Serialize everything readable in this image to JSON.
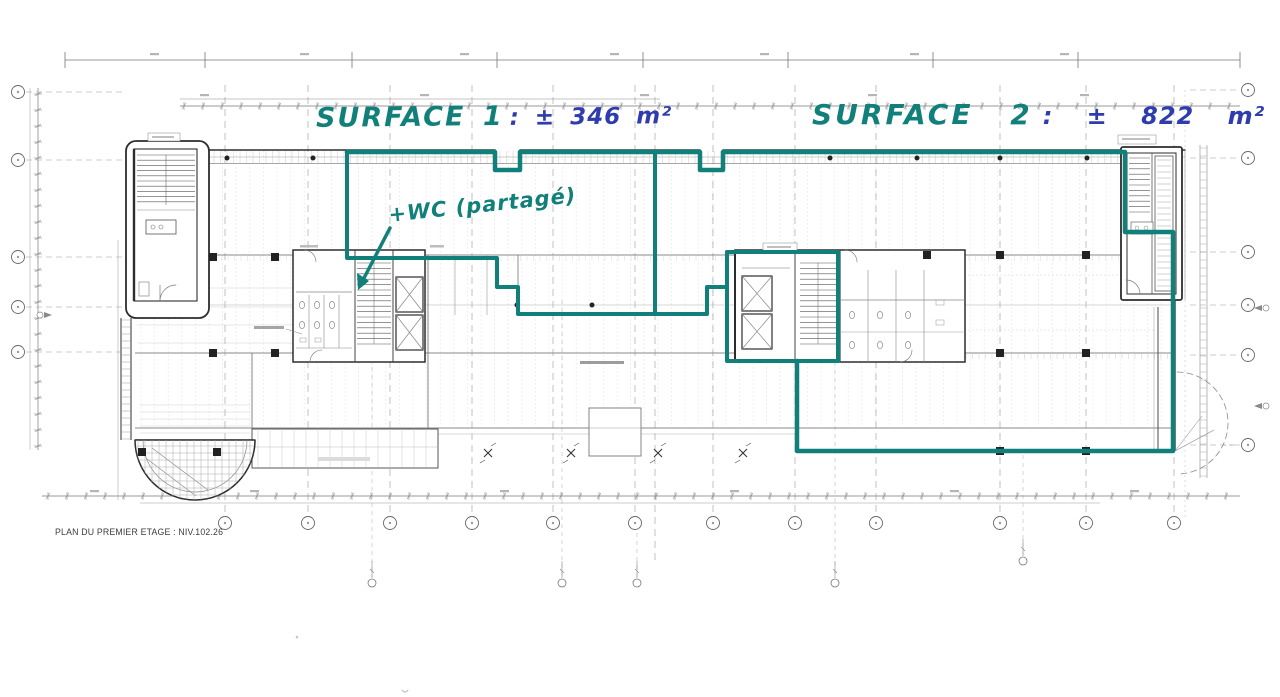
{
  "annotations": {
    "surface1": {
      "label": "SURFACE 1",
      "value": ": ± 346 m²"
    },
    "surface2": {
      "label": "SURFACE 2",
      "value": ": ± 822 m²"
    },
    "wc_note": "+WC (partagé)"
  },
  "caption": {
    "text": "PLAN DU PREMIER ETAGE : NIV.102.26"
  },
  "colors": {
    "marker_teal": "#12807a",
    "ink_blue": "#2e3cae",
    "drawing_dark": "#2d2d2d",
    "drawing_gray": "#8a8a8a"
  }
}
